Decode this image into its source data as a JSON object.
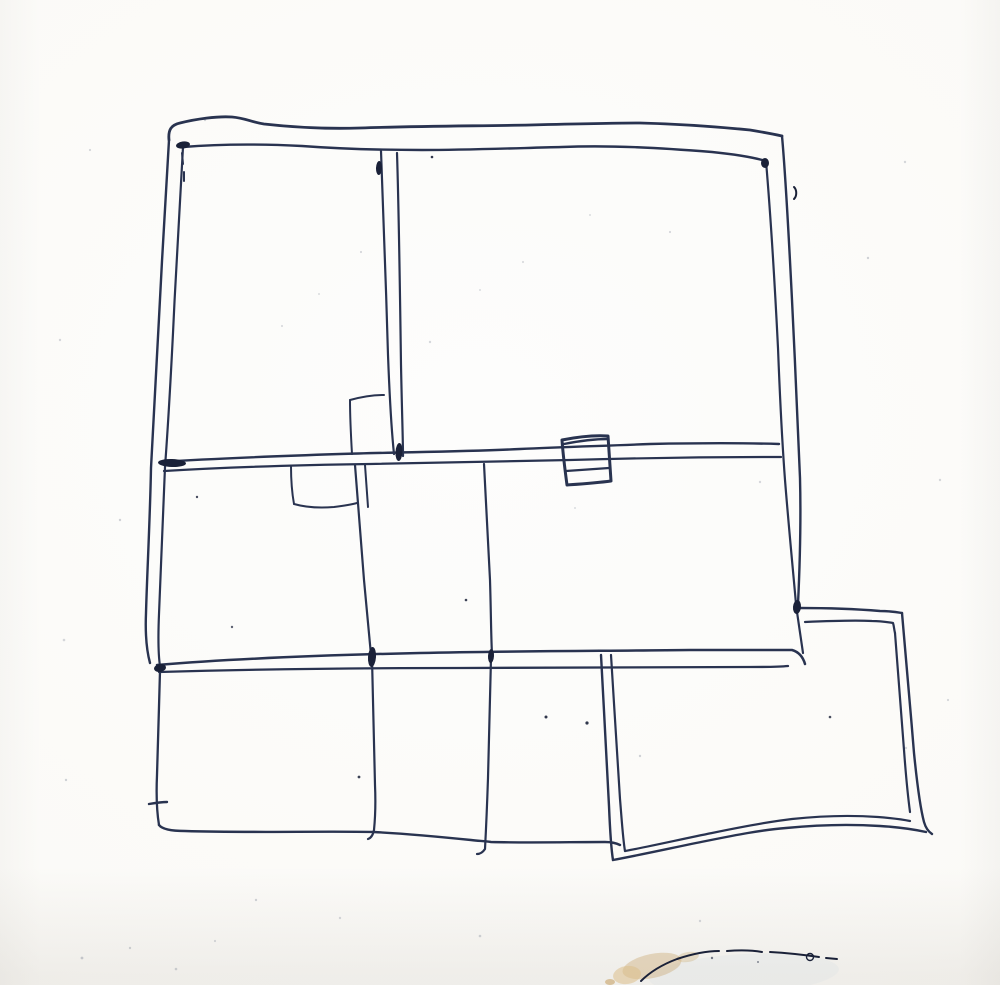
{
  "meta": {
    "description": "Hand-drawn ballpoint-pen floor plan sketch on white paper: a large two-band house outline with double-stroke walls, two interior partition notches, a small box drawn over the middle wall, a lower extension of three rooms, and an offset annex room at the bottom right; tan smudge and dark arc stain at the bottom edge of the paper"
  },
  "canvas": {
    "width": 1000,
    "height": 985
  },
  "colors": {
    "paper": "#fdfdfc",
    "paper2": "#fbfaf7",
    "paper_edge": "#f2efe9",
    "ink": "#293350",
    "ink_dark": "#1a2138",
    "speckle": "#8c93a0",
    "smudge_tan": "#c8a468",
    "smudge_light": "#dcc08a",
    "wash_blue": "#d9e1e4"
  },
  "sketch": {
    "default_width": 2.2,
    "strokes": [
      {
        "n": "outer-top-wall",
        "w": 2.8,
        "d": "M169,140 C168,130 171,125 180,123 C196,119 217,116 232,117 C245,118 251,122 264,124 C300,128 330,129 360,128 C420,126 480,126 530,125 C570,124 610,123 640,123 C680,124 720,127 750,130 C762,132 773,134 782,136"
      },
      {
        "n": "inner-top-wall",
        "w": 2.4,
        "d": "M183,147 C220,144 262,144 302,146 C342,149 382,150 422,150 C470,150 520,148 562,147 C612,145 662,148 712,152 C732,154 752,157 766,161"
      },
      {
        "n": "outer-left-wall",
        "w": 2.4,
        "d": "M169,140 C166,190 162,258 159,318 C156,378 153,428 151,468 C150,520 147,575 146,613 C145,637 147,652 150,663"
      },
      {
        "n": "inner-left-wall",
        "w": 2.2,
        "d": "M183,147 C180,200 176,268 173,333 C170,393 167,440 165,467 C163,515 161,565 159,614 C158,638 158,653 160,666"
      },
      {
        "n": "outer-right-wall",
        "w": 2.4,
        "d": "M782,136 C786,180 789,240 792,300 C795,360 798,430 800,478 C801,518 800,562 798,604"
      },
      {
        "n": "inner-right-wall",
        "w": 2.2,
        "d": "M766,161 C771,220 775,288 778,348 C780,400 782,440 785,480 C789,530 793,570 796,604"
      },
      {
        "n": "right-wall-below-annex-junction",
        "w": 2.2,
        "d": "M797,612 C799,626 801,640 803,653"
      },
      {
        "n": "middle-wall-upper",
        "w": 2.4,
        "d": "M160,462 C220,458 280,456 340,454 C400,452 460,452 520,449 C560,447 600,446 650,444 C700,443 745,443 779,444"
      },
      {
        "n": "middle-wall-lower",
        "w": 2.2,
        "d": "M164,471 C230,467 300,465 370,464 C440,463 510,461 570,460 C640,458 715,457 781,457"
      },
      {
        "n": "upper-partition-left-line",
        "w": 2.2,
        "d": "M381,151 C383,205 386,285 388,355 C390,408 392,435 394,454"
      },
      {
        "n": "upper-partition-right-line",
        "w": 2.2,
        "d": "M397,153 C399,215 400,295 401,365 C402,415 403,440 403,456"
      },
      {
        "n": "upper-notch-top",
        "w": 2.0,
        "d": "M350,400 C361,397 372,395 384,395"
      },
      {
        "n": "upper-notch-left",
        "w": 2.0,
        "d": "M350,400 C350,420 351,437 352,454"
      },
      {
        "n": "lower-notch-left",
        "w": 2.0,
        "d": "M291,466 C291,480 292,493 294,504"
      },
      {
        "n": "lower-notch-bottom",
        "w": 2.0,
        "d": "M294,504 C308,508 322,508 334,507 C342,506 350,505 357,503"
      },
      {
        "n": "midband-partition-a",
        "w": 2.2,
        "d": "M355,465 C358,505 361,545 364,580 C367,612 369,636 371,655"
      },
      {
        "n": "midband-partition-a-double",
        "w": 2.0,
        "d": "M365,465 C366,479 367,493 368,507"
      },
      {
        "n": "midband-partition-b",
        "w": 2.2,
        "d": "M484,464 C486,505 488,545 490,580 C491,612 491,636 492,654"
      },
      {
        "n": "lower-partition-a",
        "w": 2.2,
        "d": "M372,658 C373,700 374,745 375,785 C376,808 375,820 374,830 C373,835 371,838 368,839"
      },
      {
        "n": "lower-partition-b",
        "w": 2.2,
        "d": "M491,658 C490,700 489,740 488,778 C487,808 486,830 485,849 C483,852 480,854 477,854"
      },
      {
        "n": "bottom-wall-upper",
        "w": 2.5,
        "d": "M157,665 C240,658 330,655 420,653 C510,651 600,651 690,650 C730,650 770,650 792,650 C799,652 803,657 805,664"
      },
      {
        "n": "bottom-wall-lower",
        "w": 2.3,
        "d": "M159,672 C260,669 360,668 460,668 C560,668 660,667 750,667 C765,667 778,667 788,666"
      },
      {
        "n": "extension-left-wall",
        "w": 2.3,
        "d": "M160,671 C159,705 158,745 157,775 C156,798 157,813 159,825"
      },
      {
        "n": "extension-left-tick",
        "w": 2.4,
        "d": "M149,804 C155,803 161,802 167,802"
      },
      {
        "n": "extension-bottom-edge",
        "w": 2.4,
        "d": "M159,825 C162,829 170,831 185,831 C250,833 320,831 374,832 C412,834 442,837 471,840 C479,841 484,841 491,842 C530,843 570,842 605,842 C611,842 616,843 620,845"
      },
      {
        "n": "midwall-box-outline",
        "w": 3.0,
        "d": "M562,440 C577,437 592,435 608,436 C609,451 610,466 611,481 C596,483 581,484 567,485 C565,470 563,455 562,440 Z"
      },
      {
        "n": "midwall-box-top-restroke",
        "w": 2.4,
        "d": "M564,444 C579,441 594,439 608,439"
      },
      {
        "n": "midwall-box-midline",
        "w": 2.2,
        "d": "M566,471 C581,470 595,469 609,468"
      },
      {
        "n": "annex-left-outer",
        "w": 2.4,
        "d": "M601,655 C604,705 606,758 609,806 C610,830 611,848 613,860"
      },
      {
        "n": "annex-left-inner",
        "w": 2.2,
        "d": "M611,655 C614,703 617,753 620,799 C622,823 623,840 625,851"
      },
      {
        "n": "annex-top-outer",
        "w": 2.4,
        "d": "M799,608 C826,608 856,609 880,611 C888,611 896,612 902,613"
      },
      {
        "n": "annex-top-inner",
        "w": 2.2,
        "d": "M805,622 C828,621 852,620 872,621 C880,621 887,622 893,623 C894,626 894,629 895,633"
      },
      {
        "n": "annex-right-outer",
        "w": 2.4,
        "d": "M902,613 C906,655 910,705 914,753 C917,783 920,807 924,822 C926,829 929,832 932,834"
      },
      {
        "n": "annex-right-inner",
        "w": 2.2,
        "d": "M895,633 C898,670 901,710 904,750 C906,777 908,797 910,812"
      },
      {
        "n": "annex-bottom-outer",
        "w": 2.4,
        "d": "M613,860 C645,854 676,847 706,841 C736,835 761,830 786,828 C816,825 850,824 880,826 C897,827 912,829 926,832"
      },
      {
        "n": "annex-bottom-inner",
        "w": 2.2,
        "d": "M625,851 C652,846 682,839 712,833 C741,827 766,822 792,819 C820,816 850,815 878,817 C890,818 900,819 910,821"
      },
      {
        "n": "inner-corner-dash",
        "w": 2.0,
        "d": "M182,153 L183,164 M184,172 L184,181"
      },
      {
        "n": "stray-pen-tick",
        "w": 2.0,
        "c": "ink_dark",
        "d": "M794,187 C797,190 797,196 794,199"
      }
    ],
    "blobs": [
      [
        183,
        145,
        7,
        3.5,
        -8
      ],
      [
        765,
        163,
        4,
        5,
        0
      ],
      [
        399,
        452,
        3.5,
        9,
        3
      ],
      [
        379,
        168,
        3,
        7,
        2
      ],
      [
        172,
        463,
        14,
        4,
        2
      ],
      [
        160,
        668,
        6,
        4,
        -10
      ],
      [
        372,
        657,
        4,
        10,
        4
      ],
      [
        491,
        656,
        3,
        7,
        3
      ],
      [
        797,
        607,
        4,
        7,
        5
      ]
    ],
    "speckles": [
      [
        432,
        157,
        1.3,
        0.9,
        1
      ],
      [
        466,
        600,
        1.3,
        0.85,
        1
      ],
      [
        546,
        717,
        1.5,
        0.9,
        1
      ],
      [
        587,
        723,
        1.6,
        0.9,
        1
      ],
      [
        359,
        777,
        1.4,
        0.85,
        1
      ],
      [
        830,
        717,
        1.3,
        0.8,
        1
      ],
      [
        197,
        497,
        1.2,
        0.8,
        1
      ],
      [
        232,
        627,
        1.2,
        0.7,
        1
      ],
      [
        712,
        958,
        1.2,
        0.8,
        1
      ],
      [
        758,
        962,
        1.0,
        0.7,
        1
      ],
      [
        205,
        120,
        1.2,
        0.4,
        0
      ],
      [
        90,
        150,
        1.1,
        0.35,
        0
      ],
      [
        60,
        340,
        1.2,
        0.35,
        0
      ],
      [
        120,
        520,
        1.2,
        0.4,
        0
      ],
      [
        64,
        640,
        1.3,
        0.35,
        0
      ],
      [
        66,
        780,
        1.2,
        0.4,
        0
      ],
      [
        82,
        958,
        1.4,
        0.45,
        0
      ],
      [
        130,
        948,
        1.2,
        0.4,
        0
      ],
      [
        176,
        969,
        1.3,
        0.4,
        0
      ],
      [
        215,
        941,
        1.1,
        0.35,
        0
      ],
      [
        256,
        900,
        1.2,
        0.4,
        0
      ],
      [
        340,
        918,
        1.2,
        0.35,
        0
      ],
      [
        480,
        936,
        1.3,
        0.4,
        0
      ],
      [
        700,
        921,
        1.2,
        0.35,
        0
      ],
      [
        906,
        748,
        1.2,
        0.35,
        0
      ],
      [
        948,
        700,
        1.1,
        0.35,
        0
      ],
      [
        940,
        480,
        1.2,
        0.35,
        0
      ],
      [
        905,
        162,
        1.2,
        0.35,
        0
      ],
      [
        868,
        258,
        1.2,
        0.4,
        0
      ],
      [
        670,
        232,
        1.1,
        0.35,
        0
      ],
      [
        430,
        342,
        1.2,
        0.35,
        0
      ],
      [
        523,
        262,
        1.1,
        0.3,
        0
      ],
      [
        282,
        326,
        1.1,
        0.3,
        0
      ],
      [
        760,
        482,
        1.2,
        0.35,
        0
      ],
      [
        640,
        756,
        1.2,
        0.4,
        0
      ],
      [
        361,
        252,
        1.1,
        0.35,
        0
      ],
      [
        319,
        294,
        1.0,
        0.3,
        0
      ],
      [
        480,
        290,
        1.0,
        0.3,
        0
      ],
      [
        590,
        215,
        1.0,
        0.3,
        0
      ],
      [
        575,
        508,
        1.0,
        0.3,
        0
      ]
    ],
    "smudge": {
      "ellipses": [
        [
          744,
          974,
          95,
          20,
          -3,
          "wash_blue",
          0.3
        ],
        [
          652,
          966,
          30,
          12,
          -12,
          "smudge_tan",
          0.38
        ],
        [
          627,
          975,
          14,
          9,
          -8,
          "smudge_light",
          0.55
        ],
        [
          688,
          957,
          11,
          5,
          -10,
          "smudge_tan",
          0.3
        ],
        [
          610,
          982,
          5,
          3,
          0,
          "smudge_tan",
          0.6
        ]
      ],
      "arcs": [
        "M641,981 C649,973 661,965 677,959 C692,954 706,951 719,951",
        "M727,951 C739,950 751,950 762,952",
        "M770,952 C788,953 805,955 819,957",
        "M826,958 L837,959"
      ],
      "ring": [
        810,
        957,
        3.5
      ]
    }
  }
}
